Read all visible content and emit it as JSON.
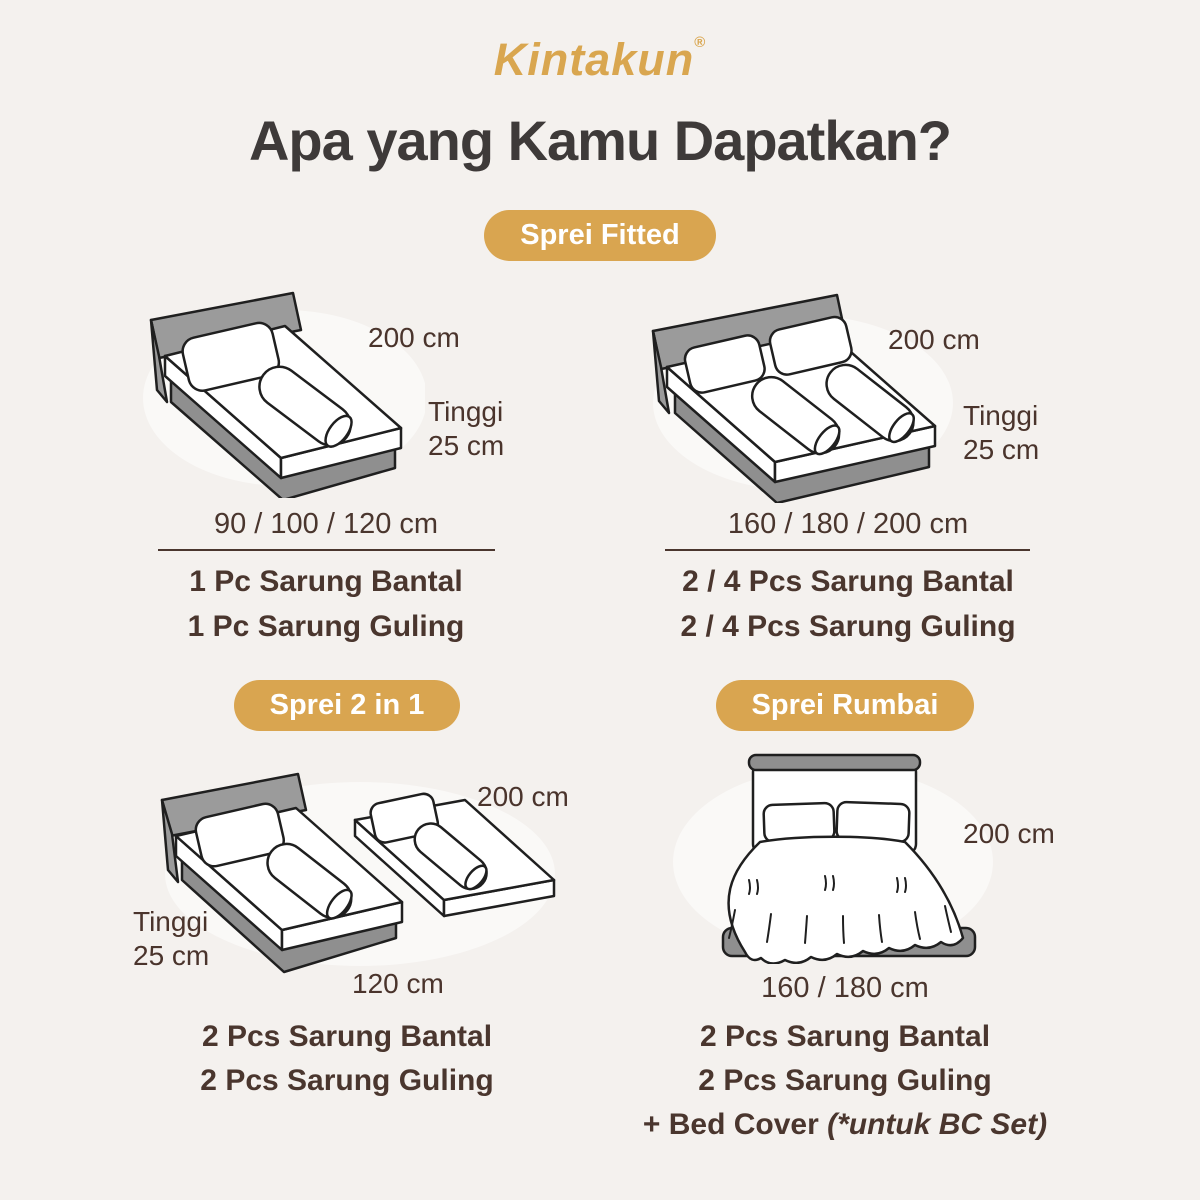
{
  "page": {
    "brand": "Kintakun",
    "registered": "®",
    "heading": "Apa yang Kamu Dapatkan?"
  },
  "colors": {
    "background": "#F4F1EE",
    "gold": "#D9A550",
    "heading_text": "#3E3A39",
    "body_text": "#4A362E"
  },
  "badges": {
    "fitted": "Sprei Fitted",
    "two_in_one": "Sprei 2 in 1",
    "rumbai": "Sprei Rumbai"
  },
  "panels": {
    "fitted_small": {
      "width_label": "200 cm",
      "height_label_1": "Tinggi",
      "height_label_2": "25 cm",
      "sizes": "90 / 100 / 120 cm",
      "item1": "1 Pc Sarung Bantal",
      "item2": "1 Pc Sarung Guling"
    },
    "fitted_large": {
      "width_label": "200 cm",
      "height_label_1": "Tinggi",
      "height_label_2": "25 cm",
      "sizes": "160 / 180 / 200 cm",
      "item1": "2 / 4 Pcs Sarung Bantal",
      "item2": "2 / 4 Pcs Sarung Guling"
    },
    "two_in_one": {
      "width_label": "200 cm",
      "height_label_1": "Tinggi",
      "height_label_2": "25 cm",
      "bottom_label": "120 cm",
      "item1": "2 Pcs Sarung Bantal",
      "item2": "2 Pcs Sarung Guling"
    },
    "rumbai": {
      "width_label": "200 cm",
      "bottom_label": "160 / 180 cm",
      "item1": "2 Pcs Sarung Bantal",
      "item2": "2 Pcs Sarung Guling",
      "item3_text": "+ Bed Cover ",
      "item3_note": "(*untuk BC Set)"
    }
  }
}
